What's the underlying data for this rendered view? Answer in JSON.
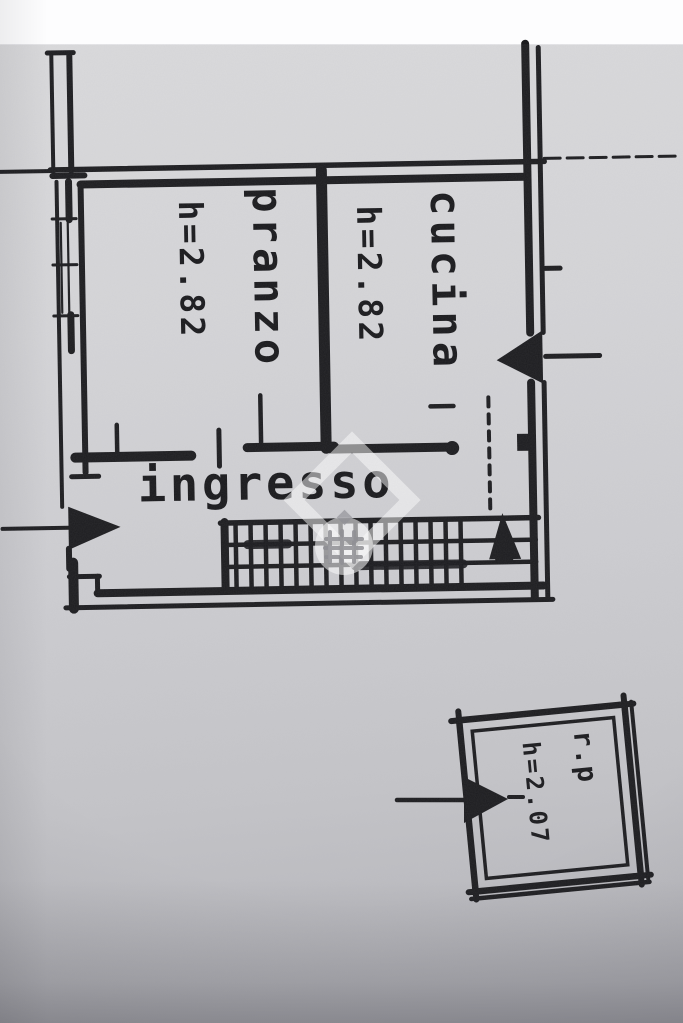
{
  "plan": {
    "rooms": {
      "pranzo": {
        "label": "pranzo",
        "height_label": "h=2.82"
      },
      "cucina": {
        "label": "cucina",
        "height_label": "h=2.82"
      },
      "ingresso": {
        "label": "ingresso"
      },
      "annex": {
        "label": "r.p",
        "height_label": "h=2.07"
      }
    },
    "symbols": {
      "entry_arrow": "entry-arrow-right",
      "balcony_arrow": "balcony-entry-arrow-left",
      "stairs_arrow": "stairs-up-arrow",
      "stairs": "stairs-grid",
      "watermark": "portal-watermark-logo"
    },
    "colors": {
      "ink": "#1c1c1f",
      "paper": "#cfcfd3",
      "scan_margin": "#fdfdfe",
      "watermark_white": "rgba(255,255,255,0.55)",
      "watermark_grid": "#8e8e93"
    }
  }
}
